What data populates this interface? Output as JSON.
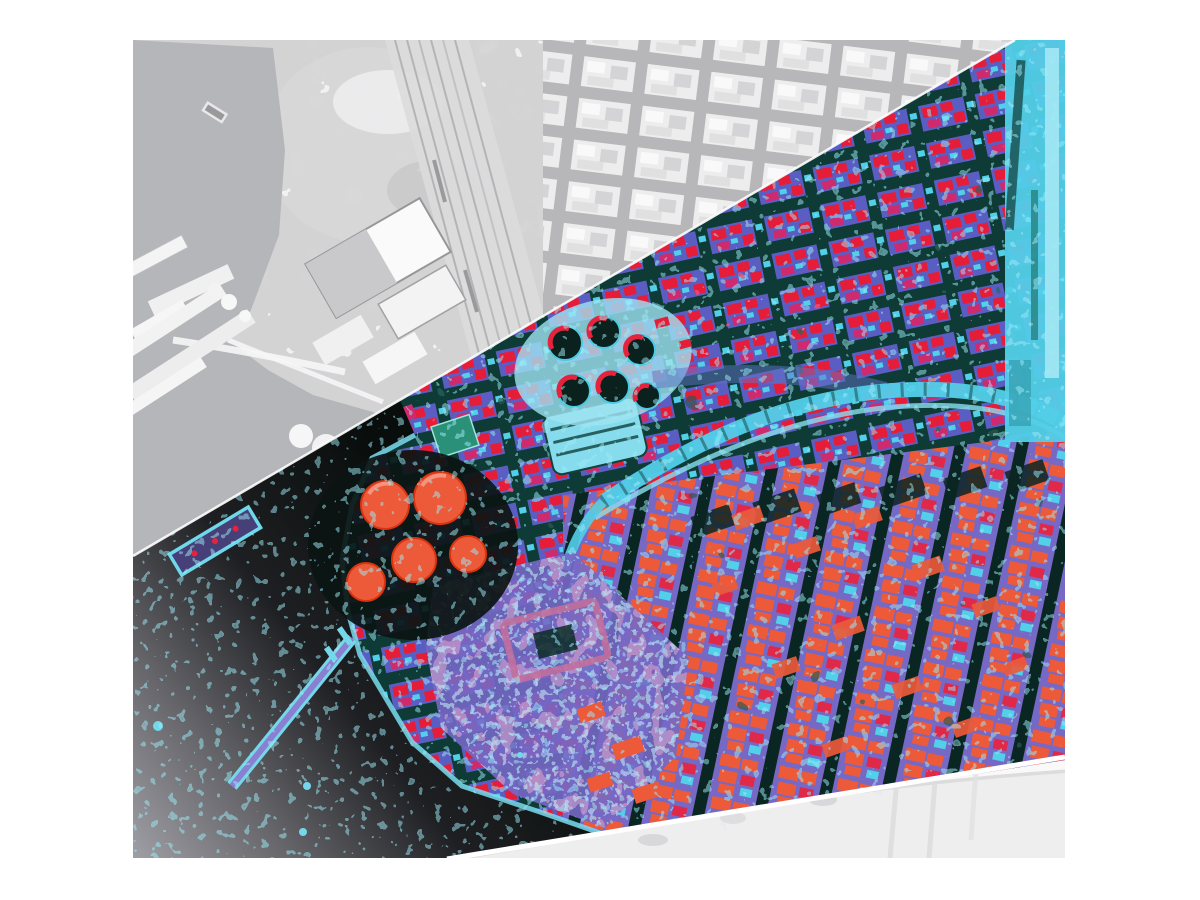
{
  "figure": {
    "kind": "remote-sensing image pair",
    "description": "Pale grayscale aerial photograph of a coastal port city overlaid by a diagonal false-color classification band",
    "layers": {
      "base": "grayscale aerial photograph",
      "overlay": "false-color classified band"
    },
    "features": [
      "harbor water",
      "docks and piers",
      "small boat",
      "warehouse roofs",
      "railway yard",
      "city blocks",
      "oil storage tanks",
      "gas works",
      "curved railway line",
      "waterfront cyan strip",
      "breakwater",
      "old town district",
      "washed bottom strip"
    ]
  },
  "palette": {
    "page_bg": "#ffffff",
    "photo_base": "#d3d3d4",
    "photo_water": "#b5b6b9",
    "photo_terrain": "#d7d7d8",
    "photo_street": "#a8a8aa",
    "photo_block": "#e9e9ea",
    "photo_white": "#f8f8f9",
    "photo_rail": "#dcdcdd",
    "photo_strip": "#eeeeef",
    "ov_street": "#0e3b35",
    "ov_street_dark": "#0a2622",
    "ov_block_blue": "#5a5ec3",
    "ov_red": "#e61d38",
    "ov_crimson": "#e02848",
    "ov_magenta": "#cf2a6e",
    "ov_cyan": "#52cfe9",
    "ov_cyan_light": "#8ae0ef",
    "ov_cyan_pale": "#9fe3f1",
    "ov_orange": "#ec5a39",
    "ov_purple": "#7668c5",
    "ov_pink": "#c06f9c",
    "ov_green": "#2a9078",
    "tank_dark": "#0b211d",
    "water_dark": "#090e0c",
    "water_mid": "#1e1f22",
    "water_gray": "#66666b",
    "water_light": "#9e9ea4",
    "boundary_white": "#ffffff"
  }
}
